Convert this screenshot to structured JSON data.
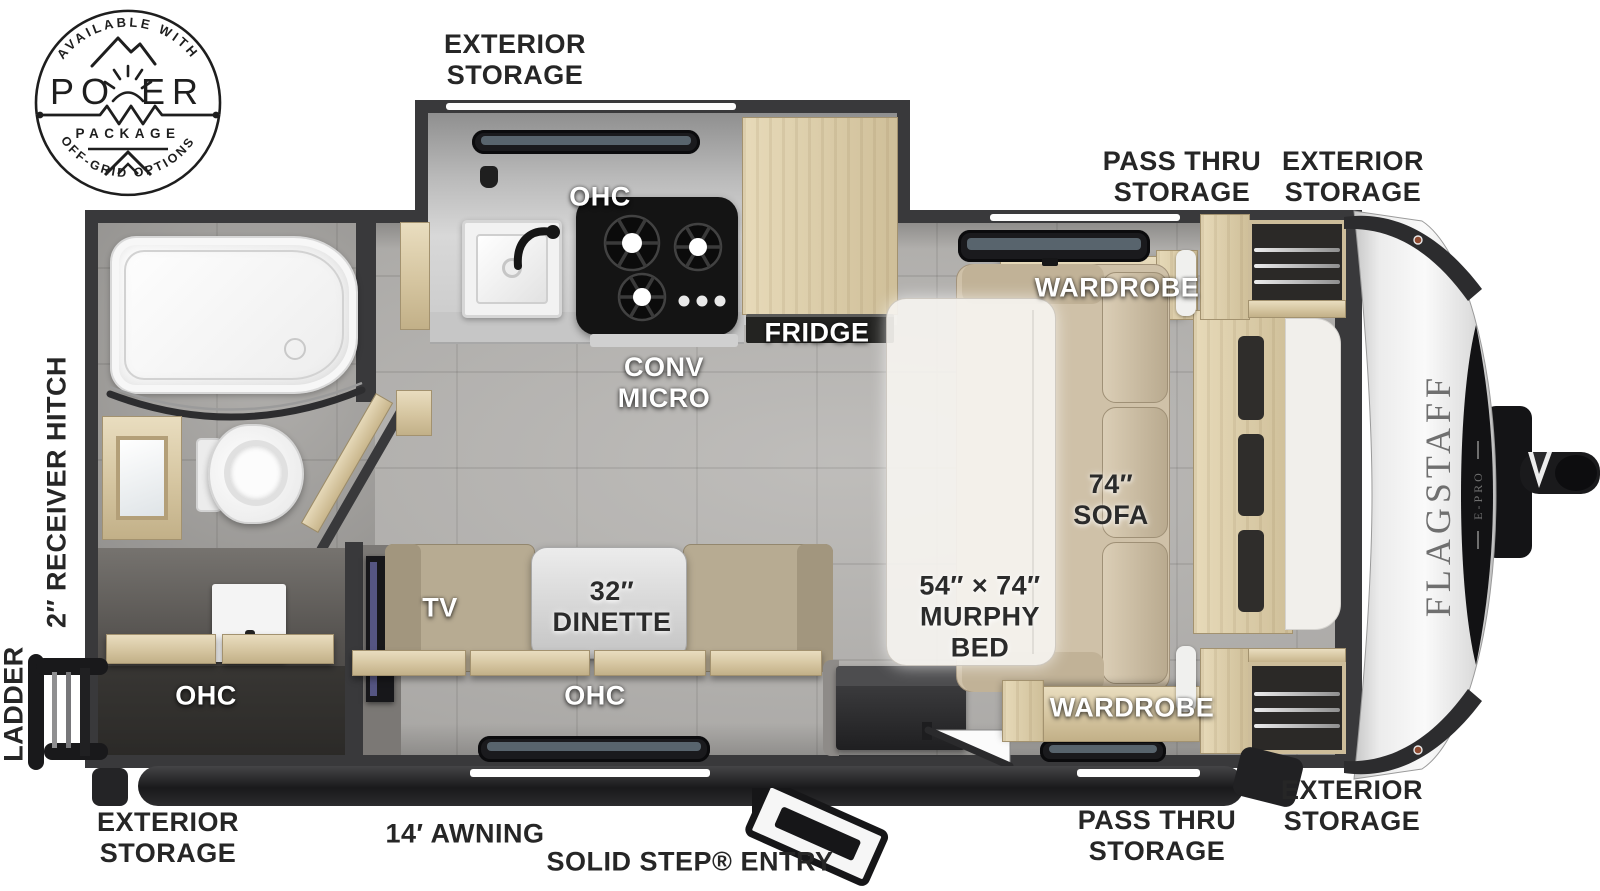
{
  "badge": {
    "arc_top": "AVAILABLE WITH",
    "word": "POWER",
    "word_left": "PO",
    "word_right": "ER",
    "subtitle": "PACKAGE",
    "arc_bottom": "OFF-GRID OPTIONS"
  },
  "brand": {
    "name": "FLAGSTAFF",
    "sub": "E-PRO"
  },
  "callouts": {
    "exterior_storage_top": [
      "EXTERIOR",
      "STORAGE"
    ],
    "pass_thru_storage_top": [
      "PASS THRU",
      "STORAGE"
    ],
    "exterior_storage_front_top": [
      "EXTERIOR",
      "STORAGE"
    ],
    "receiver_hitch": "2″ RECEIVER HITCH",
    "ladder": "LADDER",
    "ohc_kitchen": "OHC",
    "conv_micro": [
      "CONV",
      "MICRO"
    ],
    "fridge": "FRIDGE",
    "wardrobe_front_top": "WARDROBE",
    "sofa": [
      "74″",
      "SOFA"
    ],
    "murphy_bed": [
      "54″ × 74″",
      "MURPHY",
      "BED"
    ],
    "dinette": [
      "32″",
      "DINETTE"
    ],
    "tv": "TV",
    "ohc_dinette": "OHC",
    "ohc_rear": "OHC",
    "wardrobe_front_bottom": "WARDROBE",
    "exterior_storage_rear_bottom": [
      "EXTERIOR",
      "STORAGE"
    ],
    "awning": "14′ AWNING",
    "solid_step_entry": "SOLID STEP® ENTRY",
    "pass_thru_storage_bottom": [
      "PASS THRU",
      "STORAGE"
    ],
    "exterior_storage_front_bottom": [
      "EXTERIOR",
      "STORAGE"
    ]
  },
  "colors": {
    "wall": "#39393b",
    "floor": "#b6b4b1",
    "wood": "#d8c9a4",
    "sofa": "#d2c4ab",
    "mattress": "#f4f2ed",
    "label_dark": "#262626",
    "label_white": "#ffffff"
  }
}
